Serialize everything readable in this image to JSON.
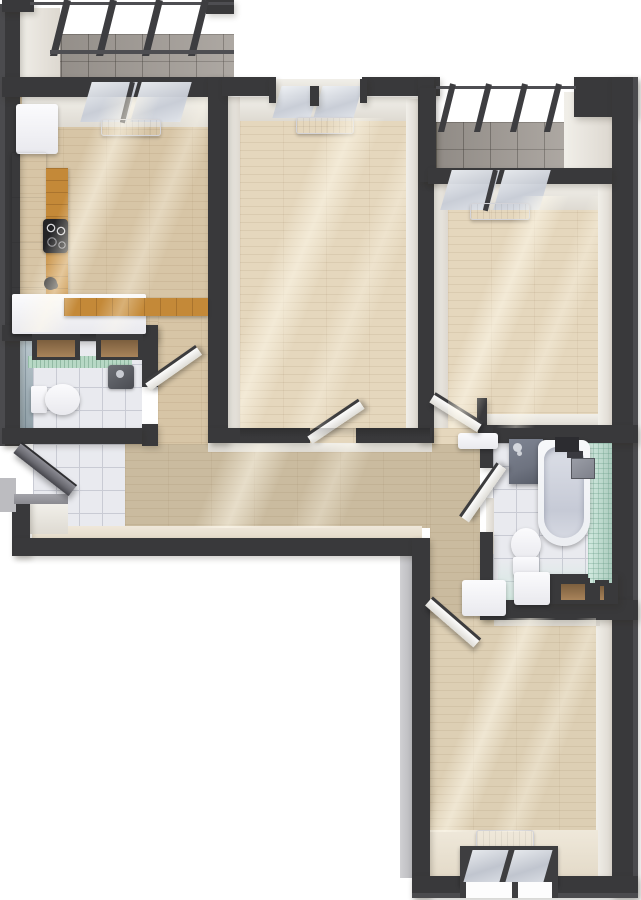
{
  "scene": {
    "title": "3D rendered apartment floor plan, top-down cutaway view",
    "background": "#ffffff"
  },
  "palette": {
    "wall": "#39393b",
    "wall-edge": "#4b4b4e",
    "wall-face": "#f1efe9",
    "wood-kitchen": "#d7c5a6",
    "wood-room": "#e5d7bd",
    "wood-hall": "#cabb9f",
    "wood-bottom": "#ddcfb4",
    "counter-wood": "#c48938",
    "tile-white": "#e9eaef",
    "tile-line": "#c9cbd4",
    "tile-gray": "#a49e98",
    "tile-teal": "#a3b5be",
    "mosaic-mint": "#bfe2d3",
    "mint-band": "#b7d8c5",
    "fixture-white": "#f5f5f7",
    "glass": "#d6dae2",
    "shower-panel": "#6e7380",
    "entrance-door": "#6b6b72",
    "niche-tan": "#a8835a",
    "cooktop-black": "#232326"
  },
  "rooms": [
    {
      "id": "balcony-top-left",
      "label": "Balcony (top left)",
      "floor": "gray tile",
      "features": [
        "glazed facade with dark mullions",
        "tile floor"
      ]
    },
    {
      "id": "kitchen",
      "label": "Kitchen",
      "floor": "light wood plank",
      "features": [
        "refrigerator",
        "tall white cabinet run",
        "L-shaped oak countertop",
        "4-burner cooktop",
        "black sink tap",
        "radiator",
        "glazed window wall to balcony"
      ]
    },
    {
      "id": "room-top-middle",
      "label": "Room (top middle)",
      "floor": "light wood plank",
      "features": [
        "window bay",
        "radiator",
        "open white door to hallway"
      ]
    },
    {
      "id": "balcony-top-right",
      "label": "Balcony (top right)",
      "floor": "gray tile",
      "features": [
        "glazed facade with dark mullions"
      ]
    },
    {
      "id": "room-top-right",
      "label": "Room (top right)",
      "floor": "light wood plank",
      "features": [
        "window wall to balcony",
        "radiator",
        "open white door to hallway"
      ]
    },
    {
      "id": "wc",
      "label": "WC",
      "floor": "white tile",
      "features": [
        "toilet",
        "corner basin",
        "blue-gray tiled wall",
        "mint tile band",
        "two wall niches",
        "open white door"
      ]
    },
    {
      "id": "entry-hall",
      "label": "Entry hall",
      "floor": "white tile",
      "features": [
        "entrance door ajar",
        "outside threshold step"
      ]
    },
    {
      "id": "hallway",
      "label": "Hallway",
      "floor": "wood plank",
      "features": [
        "open doorways to all rooms",
        "white sill cabinet"
      ]
    },
    {
      "id": "bathroom",
      "label": "Bathroom",
      "floor": "white tile",
      "features": [
        "bathtub",
        "dark shower panel",
        "black shower fitting",
        "wall shelf",
        "toilet",
        "washer cabinet",
        "mint mosaic wall",
        "two wall niches",
        "open white door"
      ]
    },
    {
      "id": "room-bottom-right",
      "label": "Room (bottom right)",
      "floor": "light wood plank",
      "features": [
        "window in bottom wall",
        "radiator",
        "open white door"
      ]
    }
  ]
}
